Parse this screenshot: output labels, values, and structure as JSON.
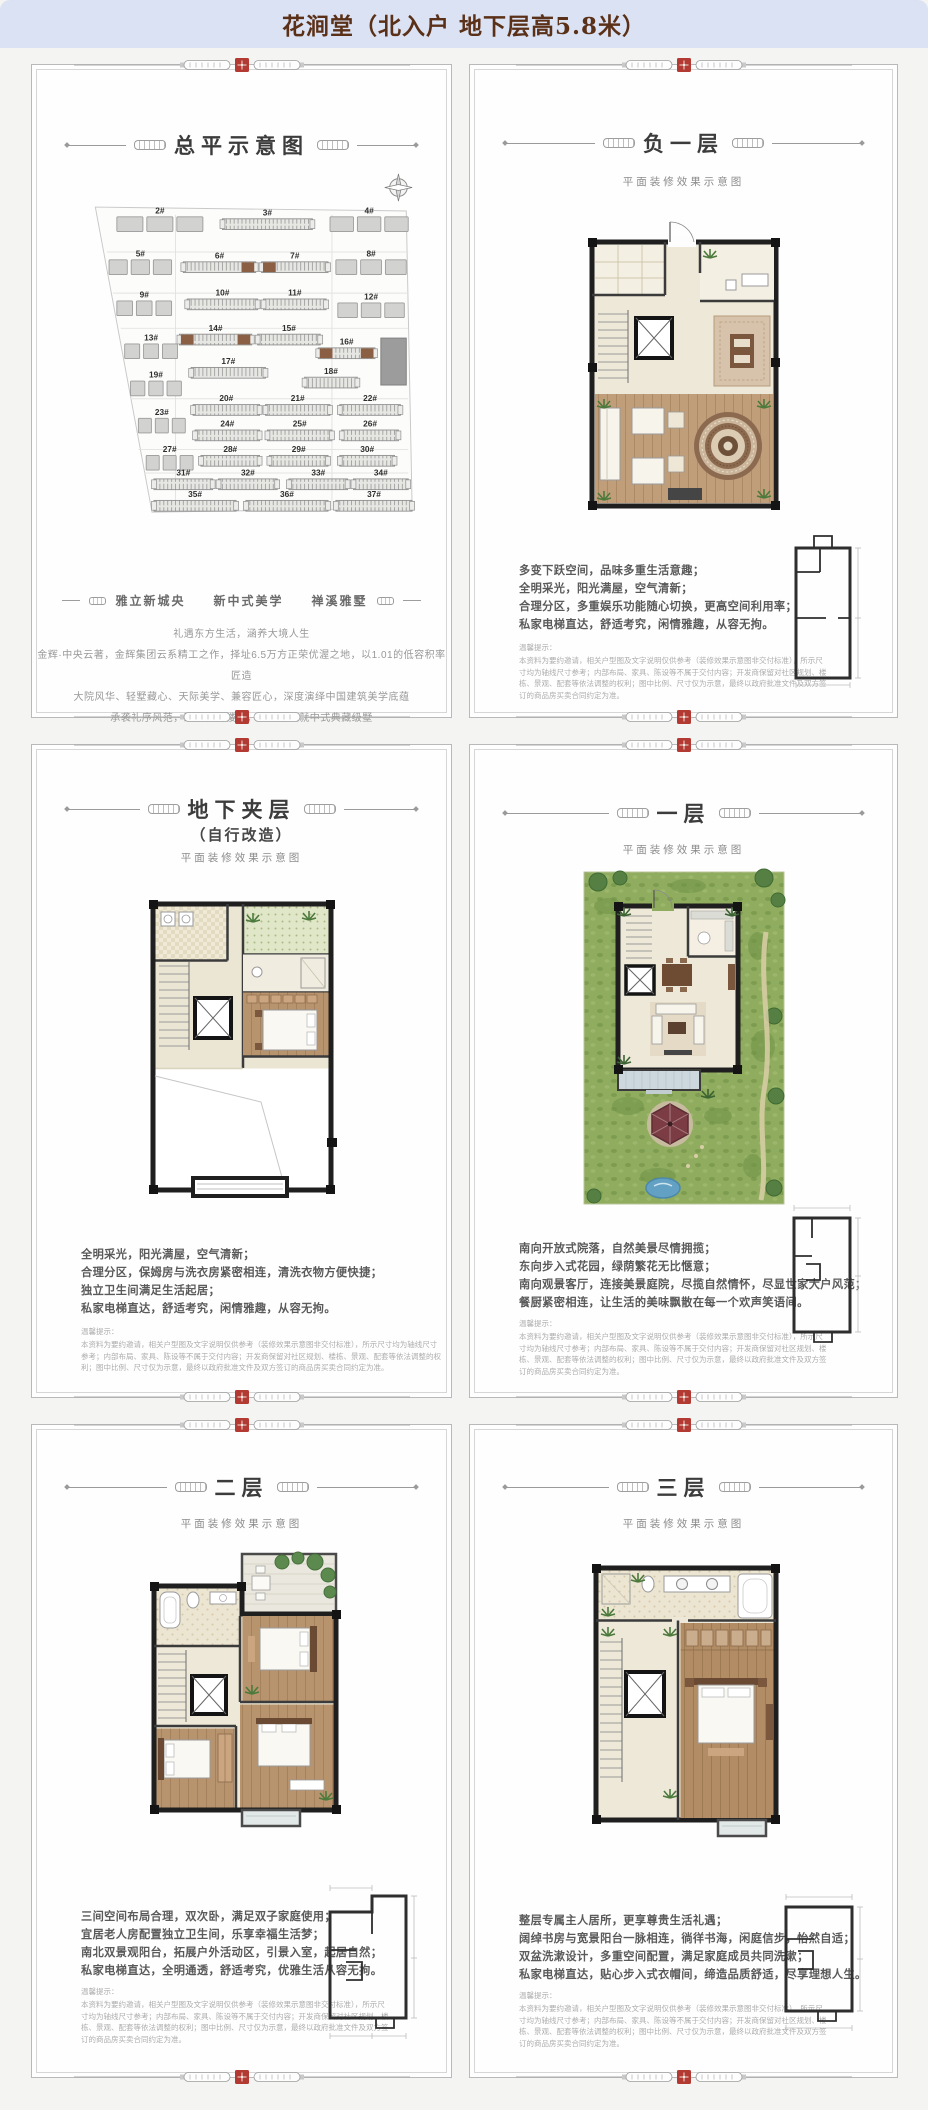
{
  "header": {
    "title": "花涧堂（北入户 地下层高5.8米）"
  },
  "common": {
    "subtitle": "平面装修效果示意图",
    "tip_title": "温馨提示：",
    "tip_body": "本资料为要约邀请，相关户型图及文字说明仅供参考（装修效果示意图非交付标准），所示尺寸均为轴线尺寸参考；内部布局、家具、陈设等不属于交付内容；开发商保留对社区规划、楼栋、景观、配套等依法调整的权利；图中比例、尺寸仅为示意，最终以政府批准文件及双方签订的商品房买卖合同约定为准。"
  },
  "colors": {
    "seal": "#b23a33",
    "header_bg": "#dbe2f3",
    "header_text": "#5a3018",
    "highlight_building": "#8a5f43"
  },
  "panels": {
    "site": {
      "title": "总平示意图",
      "tagline": "雅立新城央　　新中式美学　　禅溪雅墅",
      "paragraph": [
        "礼遇东方生活，涵养大境人生",
        "金辉·中央云著，金辉集团云系精工之作，择址6.5万方正荣优渥之地，以1.01的低容积率匠造",
        "大院风华、轻墅藏心、天际美学、兼容匠心，深度演绎中国建筑美学底蕴",
        "承袭礼序风范，致敬石门楼峰，以诚意筑就中式典藏级墅"
      ],
      "buildings": [
        "2#",
        "3#",
        "4#",
        "5#",
        "6#",
        "7#",
        "8#",
        "9#",
        "10#",
        "11#",
        "12#",
        "13#",
        "14#",
        "15#",
        "16#",
        "17#",
        "18#",
        "19#",
        "20#",
        "21#",
        "22#",
        "23#",
        "24#",
        "25#",
        "26#",
        "27#",
        "28#",
        "29#",
        "30#",
        "31#",
        "32#",
        "33#",
        "34#",
        "35#",
        "36#",
        "37#"
      ]
    },
    "b1": {
      "title": "负一层",
      "lines": [
        "多变下跃空间，品味多重生活意趣；",
        "全明采光，阳光满屋，空气清新；",
        "合理分区，多重娱乐功能随心切换，更高空间利用率；",
        "私家电梯直达，舒适考究，闲情雅趣，从容无拘。"
      ]
    },
    "mezz": {
      "title": "地下夹层",
      "title2": "（自行改造）",
      "lines": [
        "全明采光，阳光满屋，空气清新；",
        "合理分区，保姆房与洗衣房紧密相连，清洗衣物方便快捷；",
        "独立卫生间满足生活起居；",
        "私家电梯直达，舒适考究，闲情雅趣，从容无拘。"
      ]
    },
    "f1": {
      "title": "一层",
      "lines": [
        "南向开放式院落，自然美景尽情拥揽；",
        "东向步入式花园，绿荫繁花无比惬意；",
        "南向观景客厅，连接美景庭院，尽揽自然情怀，尽显世家大户风范；",
        "餐厨紧密相连，让生活的美味飘散在每一个欢声笑语间。"
      ]
    },
    "f2": {
      "title": "二层",
      "lines": [
        "三间空间布局合理，双次卧，满足双子家庭使用；",
        "宜居老人房配置独立卫生间，乐享幸福生活梦；",
        "南北双景观阳台，拓展户外活动区，引景入室，起居自然；",
        "私家电梯直达，全明通透，舒适考究，优雅生活从容无拘。"
      ]
    },
    "f3": {
      "title": "三层",
      "lines": [
        "整层专属主人居所，更享尊贵生活礼遇；",
        "阔绰书房与宽景阳台一脉相连，徜徉书海，闲庭信步，怡然自适；",
        "双盆洗漱设计，多重空间配置，满足家庭成员共同洗漱；",
        "私家电梯直达，贴心步入式衣帽间，缔造品质舒适，尽享理想人生。"
      ]
    }
  }
}
